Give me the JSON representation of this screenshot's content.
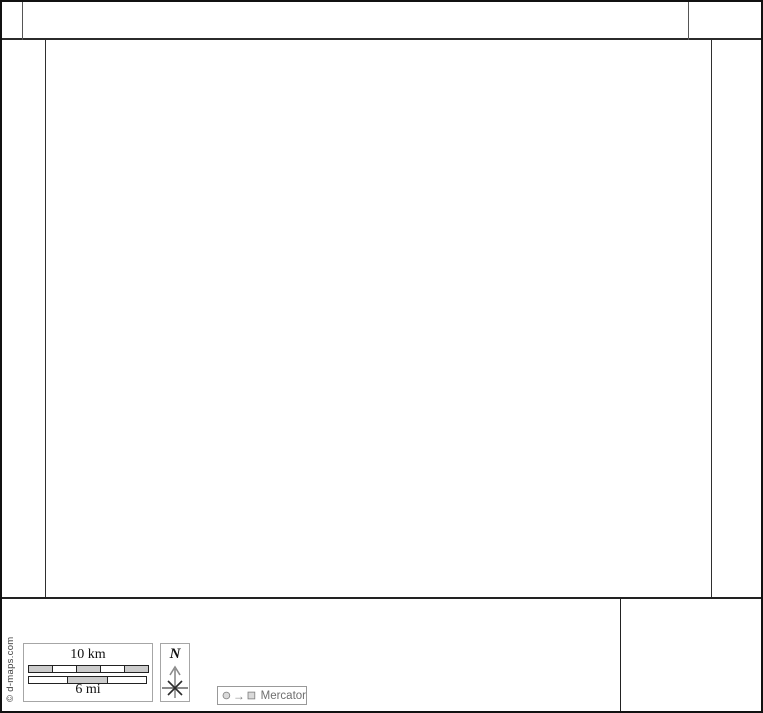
{
  "footer": {
    "copyright": "© d-maps.com",
    "scale": {
      "km_label": "10 km",
      "mi_label": "6 mi",
      "km_segment_fills": [
        "#cccccc",
        "#ffffff",
        "#cccccc",
        "#ffffff",
        "#cccccc"
      ],
      "mi_segment_fills": [
        "#ffffff",
        "#cccccc",
        "#ffffff"
      ]
    },
    "compass": {
      "north_label": "N"
    },
    "projection": {
      "symbol_arrow": "→",
      "label": "Mercator"
    }
  },
  "colors": {
    "outer_border": "#111111",
    "frame_line": "#2f2f2f",
    "panel_border": "#a6a6a6",
    "scale_gray": "#cccccc",
    "legend_gray": "#7f7f7f"
  }
}
